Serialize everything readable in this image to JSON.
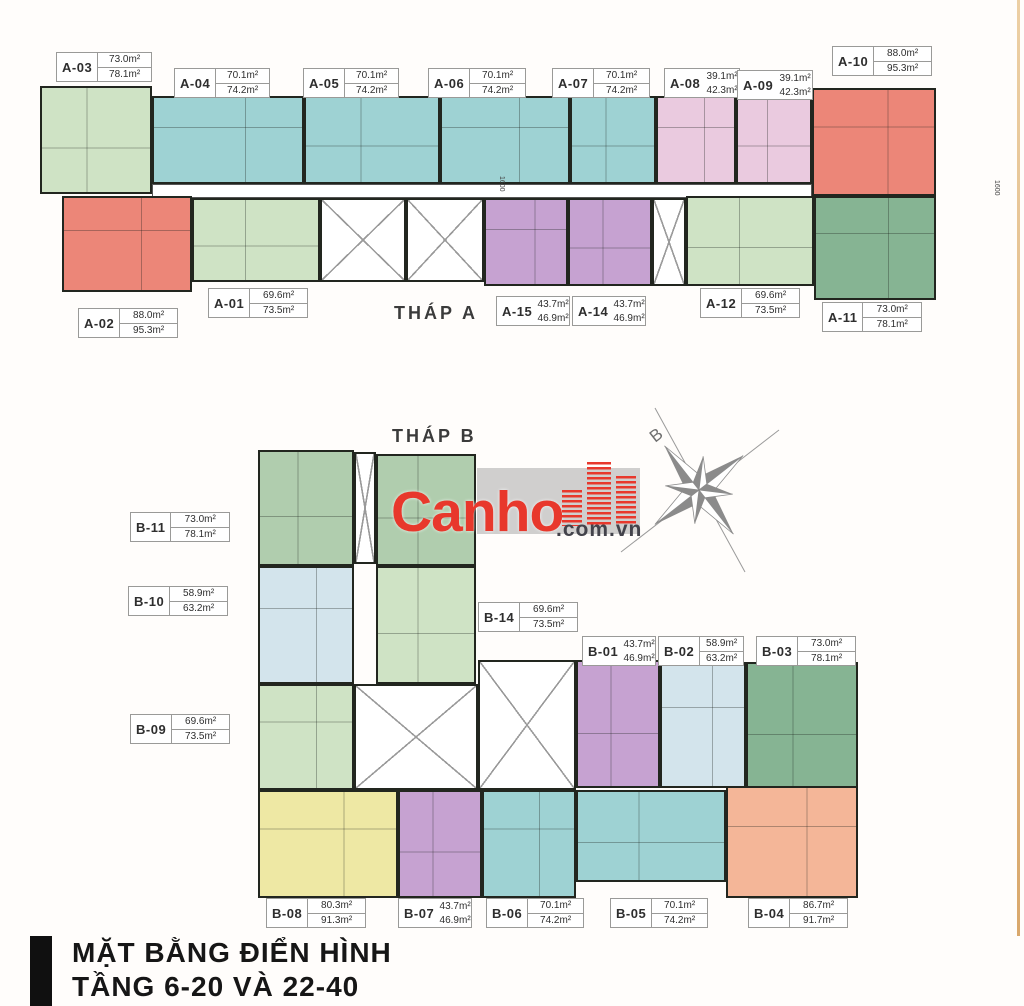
{
  "title": {
    "line1": "MẶT BẰNG ĐIỂN HÌNH",
    "line2": "TẦNG 6-20 VÀ 22-40"
  },
  "towers": [
    {
      "id": "tower-a",
      "label": "THÁP A",
      "x": 394,
      "y": 303
    },
    {
      "id": "tower-b",
      "label": "THÁP B",
      "x": 392,
      "y": 426
    }
  ],
  "logo": {
    "brand": "Canho",
    "suffix": ".com.vn",
    "brand_color": "#e8382c",
    "suffix_color": "#43434b"
  },
  "compass": {
    "letter": "B"
  },
  "dimensions": [
    {
      "text": "1600",
      "x": 505,
      "y": 176
    },
    {
      "text": "1600",
      "x": 1000,
      "y": 180
    }
  ],
  "units": [
    {
      "name": "A-03",
      "color": "green_light",
      "rect": [
        40,
        86,
        112,
        108
      ]
    },
    {
      "name": "A-04",
      "color": "teal",
      "rect": [
        152,
        96,
        152,
        88
      ]
    },
    {
      "name": "A-05",
      "color": "teal",
      "rect": [
        304,
        96,
        136,
        88
      ]
    },
    {
      "name": "A-06",
      "color": "teal",
      "rect": [
        440,
        96,
        130,
        88
      ]
    },
    {
      "name": "A-07",
      "color": "teal",
      "rect": [
        570,
        96,
        86,
        88
      ]
    },
    {
      "name": "A-08",
      "color": "pink",
      "rect": [
        656,
        96,
        80,
        88
      ]
    },
    {
      "name": "A-09",
      "color": "pink",
      "rect": [
        736,
        96,
        76,
        88
      ]
    },
    {
      "name": "A-10",
      "color": "salmon",
      "rect": [
        812,
        88,
        124,
        108
      ]
    },
    {
      "name": "corridor-a",
      "color": "core_plain",
      "rect": [
        152,
        184,
        660,
        14
      ]
    },
    {
      "name": "A-02",
      "color": "salmon",
      "rect": [
        62,
        196,
        130,
        96
      ]
    },
    {
      "name": "A-01",
      "color": "green_light",
      "rect": [
        192,
        198,
        128,
        84
      ]
    },
    {
      "name": "core-a-stairs",
      "color": "core",
      "rect": [
        320,
        198,
        86,
        84
      ]
    },
    {
      "name": "core-a-lifts",
      "color": "core",
      "rect": [
        406,
        198,
        78,
        84
      ]
    },
    {
      "name": "A-15",
      "color": "purple",
      "rect": [
        484,
        198,
        84,
        88
      ]
    },
    {
      "name": "A-14",
      "color": "purple",
      "rect": [
        568,
        198,
        84,
        88
      ]
    },
    {
      "name": "core-a-stairs-2",
      "color": "core",
      "rect": [
        652,
        198,
        34,
        88
      ]
    },
    {
      "name": "A-12",
      "color": "green_light",
      "rect": [
        686,
        196,
        128,
        90
      ]
    },
    {
      "name": "A-11",
      "color": "green_dark",
      "rect": [
        814,
        196,
        122,
        104
      ]
    },
    {
      "name": "B-11",
      "color": "green_mid",
      "rect": [
        258,
        450,
        96,
        116
      ]
    },
    {
      "name": "core-b-top",
      "color": "core",
      "rect": [
        354,
        452,
        22,
        112
      ]
    },
    {
      "name": "B-top-right",
      "color": "green_mid",
      "rect": [
        376,
        454,
        100,
        112
      ]
    },
    {
      "name": "B-10",
      "color": "pale_blue",
      "rect": [
        258,
        566,
        96,
        118
      ]
    },
    {
      "name": "B-14",
      "color": "green_light",
      "rect": [
        376,
        566,
        100,
        118
      ]
    },
    {
      "name": "B-09",
      "color": "green_light",
      "rect": [
        258,
        684,
        96,
        106
      ]
    },
    {
      "name": "core-b-main",
      "color": "core",
      "rect": [
        354,
        684,
        124,
        106
      ]
    },
    {
      "name": "core-b-lifts",
      "color": "core",
      "rect": [
        478,
        660,
        98,
        130
      ]
    },
    {
      "name": "B-01",
      "color": "purple",
      "rect": [
        576,
        660,
        84,
        128
      ]
    },
    {
      "name": "B-02",
      "color": "pale_blue",
      "rect": [
        660,
        662,
        86,
        126
      ]
    },
    {
      "name": "B-03",
      "color": "green_dark",
      "rect": [
        746,
        662,
        112,
        126
      ]
    },
    {
      "name": "B-08",
      "color": "yellow",
      "rect": [
        258,
        790,
        140,
        108
      ]
    },
    {
      "name": "B-07",
      "color": "purple",
      "rect": [
        398,
        790,
        84,
        108
      ]
    },
    {
      "name": "B-06",
      "color": "teal",
      "rect": [
        482,
        790,
        94,
        108
      ]
    },
    {
      "name": "B-05",
      "color": "teal",
      "rect": [
        576,
        790,
        150,
        92
      ]
    },
    {
      "name": "B-04",
      "color": "peach",
      "rect": [
        726,
        786,
        132,
        112
      ]
    }
  ],
  "unit_labels": [
    {
      "unit": "A-03",
      "area_top": "73.0m²",
      "area_bottom": "78.1m²",
      "x": 56,
      "y": 52,
      "w": 96,
      "compact": false
    },
    {
      "unit": "A-04",
      "area_top": "70.1m²",
      "area_bottom": "74.2m²",
      "x": 174,
      "y": 68,
      "w": 96,
      "compact": false
    },
    {
      "unit": "A-05",
      "area_top": "70.1m²",
      "area_bottom": "74.2m²",
      "x": 303,
      "y": 68,
      "w": 96,
      "compact": false
    },
    {
      "unit": "A-06",
      "area_top": "70.1m²",
      "area_bottom": "74.2m²",
      "x": 428,
      "y": 68,
      "w": 98,
      "compact": false
    },
    {
      "unit": "A-07",
      "area_top": "70.1m²",
      "area_bottom": "74.2m²",
      "x": 552,
      "y": 68,
      "w": 98,
      "compact": false
    },
    {
      "unit": "A-08",
      "area_top": "39.1m²",
      "area_bottom": "42.3m²",
      "x": 664,
      "y": 68,
      "w": 76,
      "compact": true
    },
    {
      "unit": "A-09",
      "area_top": "39.1m²",
      "area_bottom": "42.3m²",
      "x": 737,
      "y": 70,
      "w": 76,
      "compact": true
    },
    {
      "unit": "A-10",
      "area_top": "88.0m²",
      "area_bottom": "95.3m²",
      "x": 832,
      "y": 46,
      "w": 100,
      "compact": false
    },
    {
      "unit": "A-02",
      "area_top": "88.0m²",
      "area_bottom": "95.3m²",
      "x": 78,
      "y": 308,
      "w": 100,
      "compact": false
    },
    {
      "unit": "A-01",
      "area_top": "69.6m²",
      "area_bottom": "73.5m²",
      "x": 208,
      "y": 288,
      "w": 100,
      "compact": false
    },
    {
      "unit": "A-15",
      "area_top": "43.7m²",
      "area_bottom": "46.9m²",
      "x": 496,
      "y": 296,
      "w": 74,
      "compact": true
    },
    {
      "unit": "A-14",
      "area_top": "43.7m²",
      "area_bottom": "46.9m²",
      "x": 572,
      "y": 296,
      "w": 74,
      "compact": true
    },
    {
      "unit": "A-12",
      "area_top": "69.6m²",
      "area_bottom": "73.5m²",
      "x": 700,
      "y": 288,
      "w": 100,
      "compact": false
    },
    {
      "unit": "A-11",
      "area_top": "73.0m²",
      "area_bottom": "78.1m²",
      "x": 822,
      "y": 302,
      "w": 100,
      "compact": false
    },
    {
      "unit": "B-11",
      "area_top": "73.0m²",
      "area_bottom": "78.1m²",
      "x": 130,
      "y": 512,
      "w": 100,
      "compact": false
    },
    {
      "unit": "B-10",
      "area_top": "58.9m²",
      "area_bottom": "63.2m²",
      "x": 128,
      "y": 586,
      "w": 100,
      "compact": false
    },
    {
      "unit": "B-14",
      "area_top": "69.6m²",
      "area_bottom": "73.5m²",
      "x": 478,
      "y": 602,
      "w": 100,
      "compact": false
    },
    {
      "unit": "B-01",
      "area_top": "43.7m²",
      "area_bottom": "46.9m²",
      "x": 582,
      "y": 636,
      "w": 74,
      "compact": true
    },
    {
      "unit": "B-02",
      "area_top": "58.9m²",
      "area_bottom": "63.2m²",
      "x": 658,
      "y": 636,
      "w": 86,
      "compact": false
    },
    {
      "unit": "B-03",
      "area_top": "73.0m²",
      "area_bottom": "78.1m²",
      "x": 756,
      "y": 636,
      "w": 100,
      "compact": false
    },
    {
      "unit": "B-09",
      "area_top": "69.6m²",
      "area_bottom": "73.5m²",
      "x": 130,
      "y": 714,
      "w": 100,
      "compact": false
    },
    {
      "unit": "B-08",
      "area_top": "80.3m²",
      "area_bottom": "91.3m²",
      "x": 266,
      "y": 898,
      "w": 100,
      "compact": false
    },
    {
      "unit": "B-07",
      "area_top": "43.7m²",
      "area_bottom": "46.9m²",
      "x": 398,
      "y": 898,
      "w": 74,
      "compact": true
    },
    {
      "unit": "B-06",
      "area_top": "70.1m²",
      "area_bottom": "74.2m²",
      "x": 486,
      "y": 898,
      "w": 98,
      "compact": false
    },
    {
      "unit": "B-05",
      "area_top": "70.1m²",
      "area_bottom": "74.2m²",
      "x": 610,
      "y": 898,
      "w": 98,
      "compact": false
    },
    {
      "unit": "B-04",
      "area_top": "86.7m²",
      "area_bottom": "91.7m²",
      "x": 748,
      "y": 898,
      "w": 100,
      "compact": false
    }
  ]
}
